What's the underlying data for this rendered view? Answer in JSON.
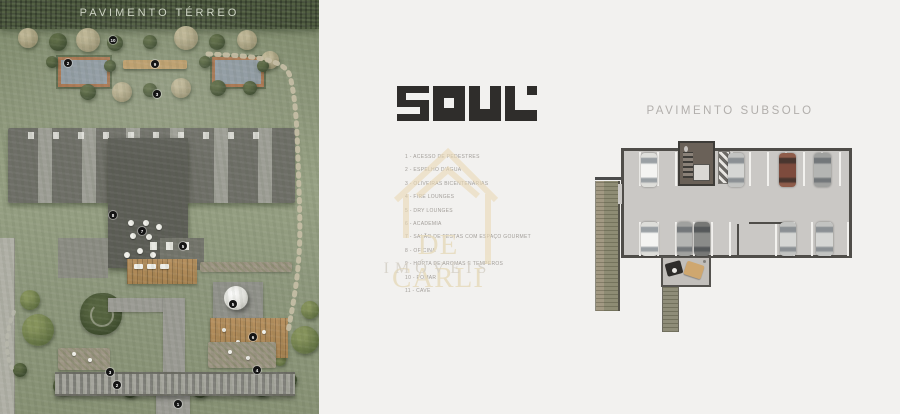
{
  "left_panel": {
    "title": "PAVIMENTO TÉRREO",
    "markers": [
      {
        "n": "10",
        "x": 113,
        "y": 40
      },
      {
        "n": "9",
        "x": 155,
        "y": 64
      },
      {
        "n": "2",
        "x": 68,
        "y": 63
      },
      {
        "n": "3",
        "x": 157,
        "y": 94
      },
      {
        "n": "8",
        "x": 113,
        "y": 215
      },
      {
        "n": "7",
        "x": 142,
        "y": 231
      },
      {
        "n": "5",
        "x": 183,
        "y": 246
      },
      {
        "n": "5",
        "x": 233,
        "y": 304
      },
      {
        "n": "6",
        "x": 253,
        "y": 337
      },
      {
        "n": "3",
        "x": 110,
        "y": 372
      },
      {
        "n": "4",
        "x": 257,
        "y": 370
      },
      {
        "n": "2",
        "x": 117,
        "y": 385
      },
      {
        "n": "1",
        "x": 178,
        "y": 404
      }
    ]
  },
  "logo": {
    "text": "SOUL"
  },
  "legend": {
    "items": [
      "1 - ACESSO DE PEDESTRES",
      "2 - ESPELHO D'ÁGUA",
      "3 - OLIVEIRAS BICENTENÁRIAS",
      "4 - FIRE LOUNGES",
      "5 - DRY LOUNGES",
      "6 - ACADEMIA",
      "7 - SALÃO DE FESTAS COM ESPAÇO GOURMET",
      "8 - OFICINA",
      "9 - HORTA DE AROMAS E TEMPEROS",
      "10 - POMAR",
      "11 - CAVE"
    ]
  },
  "watermark": {
    "line1": "DE CARLI",
    "line2": "IMÓVEIS"
  },
  "right_panel": {
    "title": "PAVIMENTO SUBSOLO",
    "cars": [
      {
        "x": 641,
        "y": 153,
        "w": 16,
        "h": 34,
        "color": "white"
      },
      {
        "x": 728,
        "y": 153,
        "w": 16,
        "h": 34,
        "color": "silver"
      },
      {
        "x": 779,
        "y": 153,
        "w": 17,
        "h": 34,
        "color": "maroon"
      },
      {
        "x": 814,
        "y": 153,
        "w": 17,
        "h": 34,
        "color": "gray"
      },
      {
        "x": 641,
        "y": 222,
        "w": 17,
        "h": 34,
        "color": "white"
      },
      {
        "x": 677,
        "y": 222,
        "w": 15,
        "h": 34,
        "color": "gray"
      },
      {
        "x": 694,
        "y": 222,
        "w": 16,
        "h": 34,
        "color": "dark"
      },
      {
        "x": 780,
        "y": 222,
        "w": 16,
        "h": 34,
        "color": "silver"
      },
      {
        "x": 816,
        "y": 222,
        "w": 17,
        "h": 34,
        "color": "silver"
      }
    ]
  },
  "colors": {
    "logo": "#2f2d2b",
    "watermark_gold": "#e7dcc0",
    "grass": "#8d977c",
    "garage_floor": "#cac8c5",
    "garage_wall": "#4f4d49",
    "deck_wood": "#b6905f"
  }
}
